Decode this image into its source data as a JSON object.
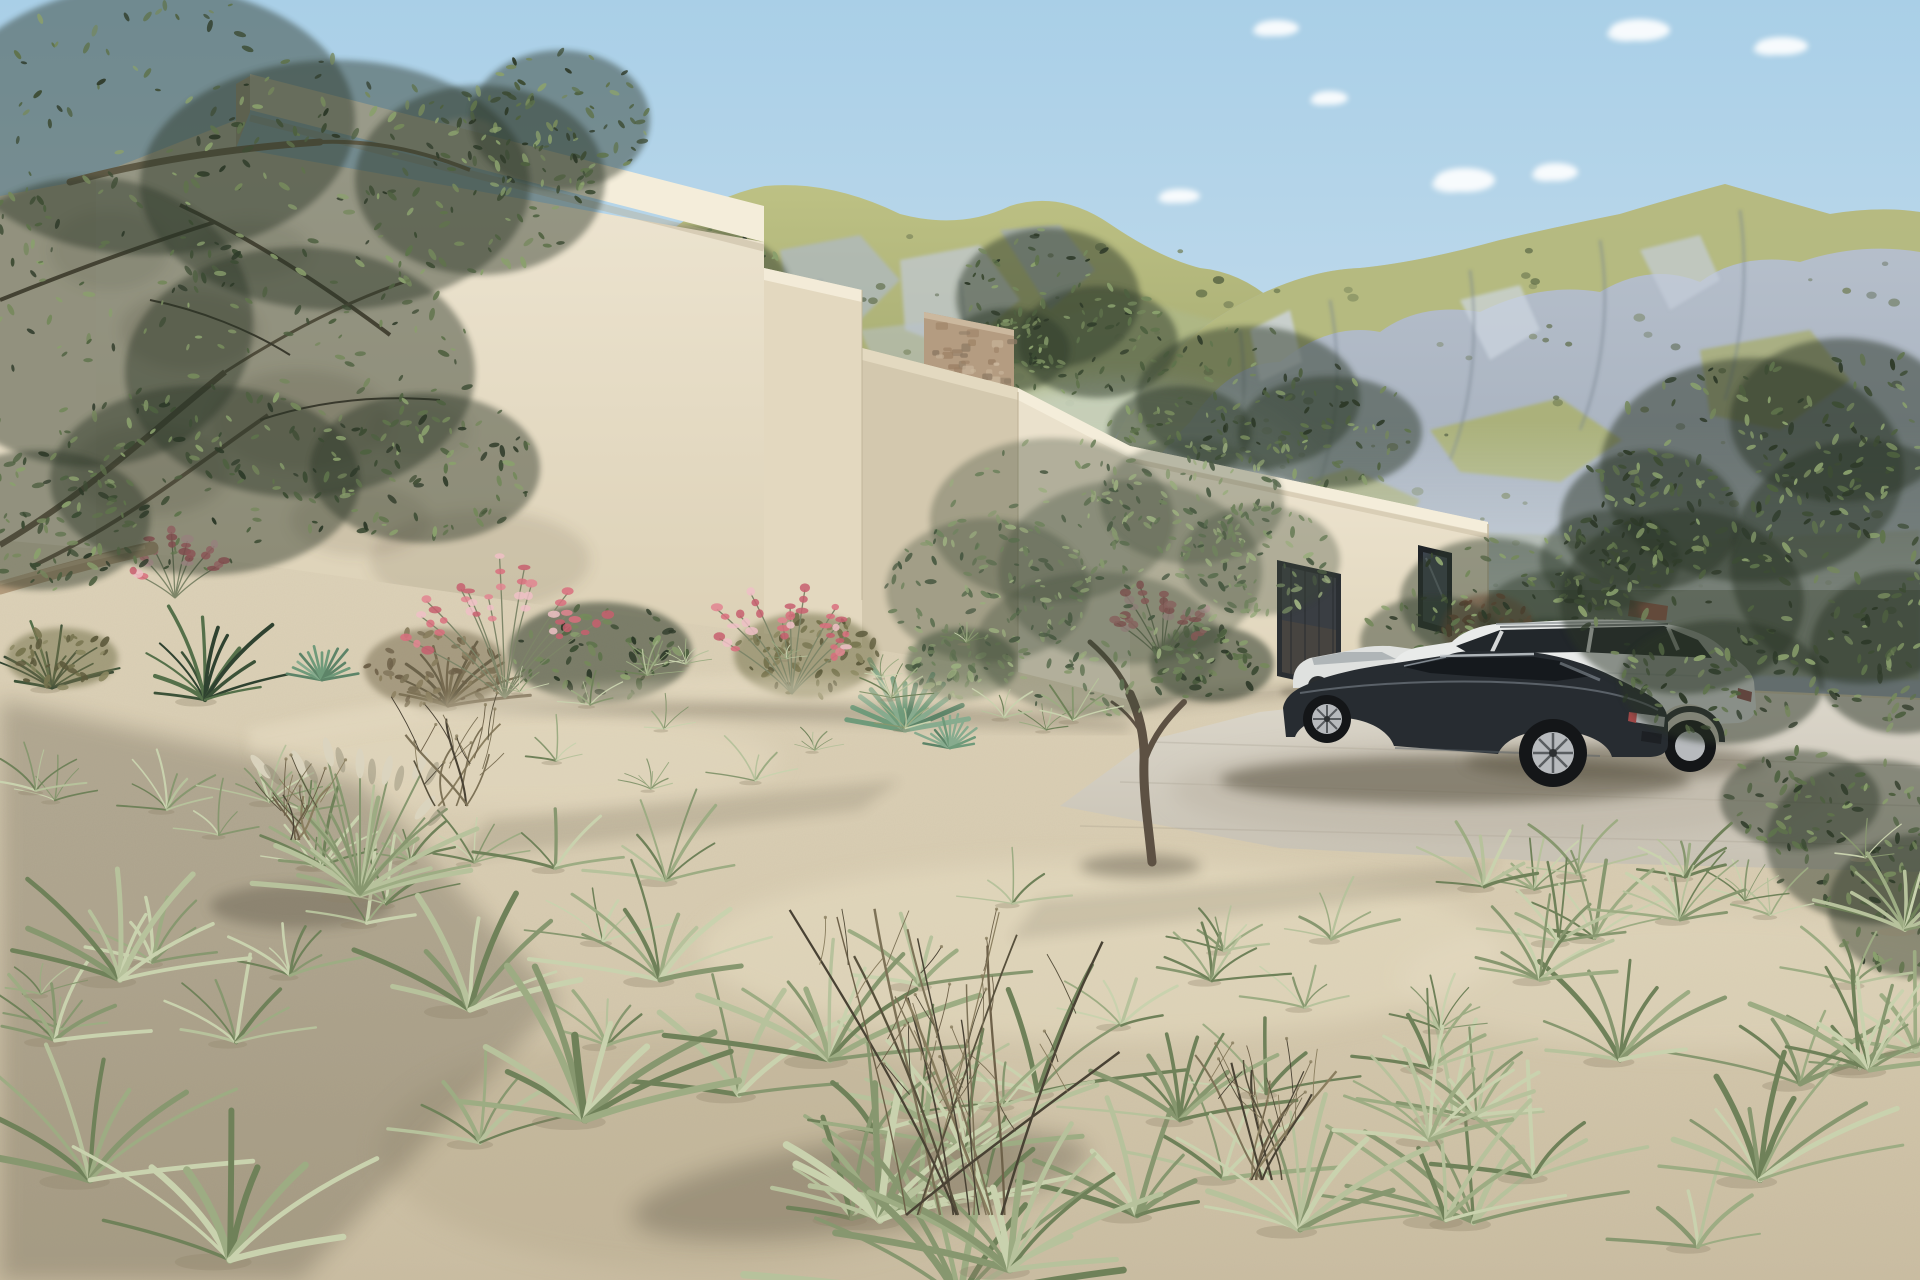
{
  "scene": {
    "type": "3d-architectural-exterior-render",
    "elements": [
      "sky",
      "clouds",
      "mountain-range-left",
      "mountain-range-right",
      "stone-wall",
      "modern-beige-villa",
      "tall-block",
      "garden-walls",
      "garage-wing",
      "garage-door",
      "slot-window",
      "olive-tree-foreground-left",
      "olive-tree-center",
      "background-trees",
      "garden-bed-flowers",
      "agave",
      "driveway",
      "dark-sports-sedan",
      "white-suv",
      "silver-car",
      "sand-dune-ground",
      "grass-tufts",
      "dry-bush",
      "plume-grass"
    ]
  },
  "palette": {
    "sky_top": "#a9cfe7",
    "sky_mid": "#c6ddec",
    "sky_horizon": "#dcecf3",
    "cloud": "#ffffff",
    "mtn_grass_hi": "#bdc184",
    "mtn_grass_lo": "#969c66",
    "mtn_rock_hi": "#b9c2ce",
    "mtn_rock_lo": "#98a3b1",
    "mtn_rock_light": "#cdd5df",
    "mtn_rock_mid": "#a6b1c0",
    "mtn_rock_dark": "#76828f",
    "saddle_green": "#aeb887",
    "haze": "#e8f0f4",
    "wall_lit": "#ece3cf",
    "wall_cap": "#f4edda",
    "wall_shade": "#d3c8ae",
    "wall_deep": "#b9ad90",
    "wall_mid": "#e3d8bf",
    "wall_right": "#eae1cc",
    "stone": "#b49c81",
    "stone_dark": "#8d7a64",
    "stone_light": "#cbb89e",
    "roof_tile": "#9c5a49",
    "garage": "#3a3e43",
    "garage_dark": "#2b2f33",
    "garage_warm": "#594b3e",
    "frame": "#202428",
    "glass": "#3e4650",
    "ground_hi": "#e9dfc6",
    "ground_mid": "#d5c9ae",
    "ground_lo": "#cabda1",
    "ground_shadow": "#6b604c",
    "drive": "#d6d1c5",
    "drive_shadow": "#b9b1a2",
    "grass": [
      "#b7c29c",
      "#9dac83",
      "#c9d2ae",
      "#87976f",
      "#6f8159"
    ],
    "grass_dark": [
      "#3c5238",
      "#2f4230",
      "#55704a"
    ],
    "plume": "#dad4bf",
    "foliage_dark": [
      "#2e3a29",
      "#3d4c34",
      "#4e6040",
      "#5f734c",
      "#75885c",
      "#8aa06d"
    ],
    "foliage_olive": [
      "#4a5a43",
      "#5c6e50",
      "#70825e",
      "#86986e",
      "#9aac7e"
    ],
    "olive_brown": [
      "#77744f",
      "#8a8660",
      "#5d5a3c"
    ],
    "trunk": "#5d5143",
    "branch": "#8a7860",
    "branch_dark": "#5a4e3f",
    "branch_pale": "#b29b7c",
    "dry": [
      "#6e6149",
      "#57503c",
      "#7d7257",
      "#494234",
      "#8a7e5f"
    ],
    "flower_pink": [
      "#e28591",
      "#d96e7e",
      "#eec0c6",
      "#c75f6f"
    ],
    "flower_stem": "#7d8568",
    "rust": [
      "#a05a43",
      "#8a4a38",
      "#b06a50"
    ],
    "agave": [
      "#6f9a7a",
      "#5d8468",
      "#87ab8e"
    ],
    "car_dark": "#272c31",
    "car_dark_hi": "#8b939b",
    "car_glass": "#15191d",
    "wheel_rim": "#b7babd",
    "tire": "#141618",
    "tail_light": "#c9cbcd",
    "tail_red": "#a04848",
    "car_white": "#e9ebea",
    "car_white_shade": "#c2c6c8",
    "suv_glass": "#22272b",
    "car_silver": "#dfe1df",
    "shadow": "#3f3a2e"
  }
}
